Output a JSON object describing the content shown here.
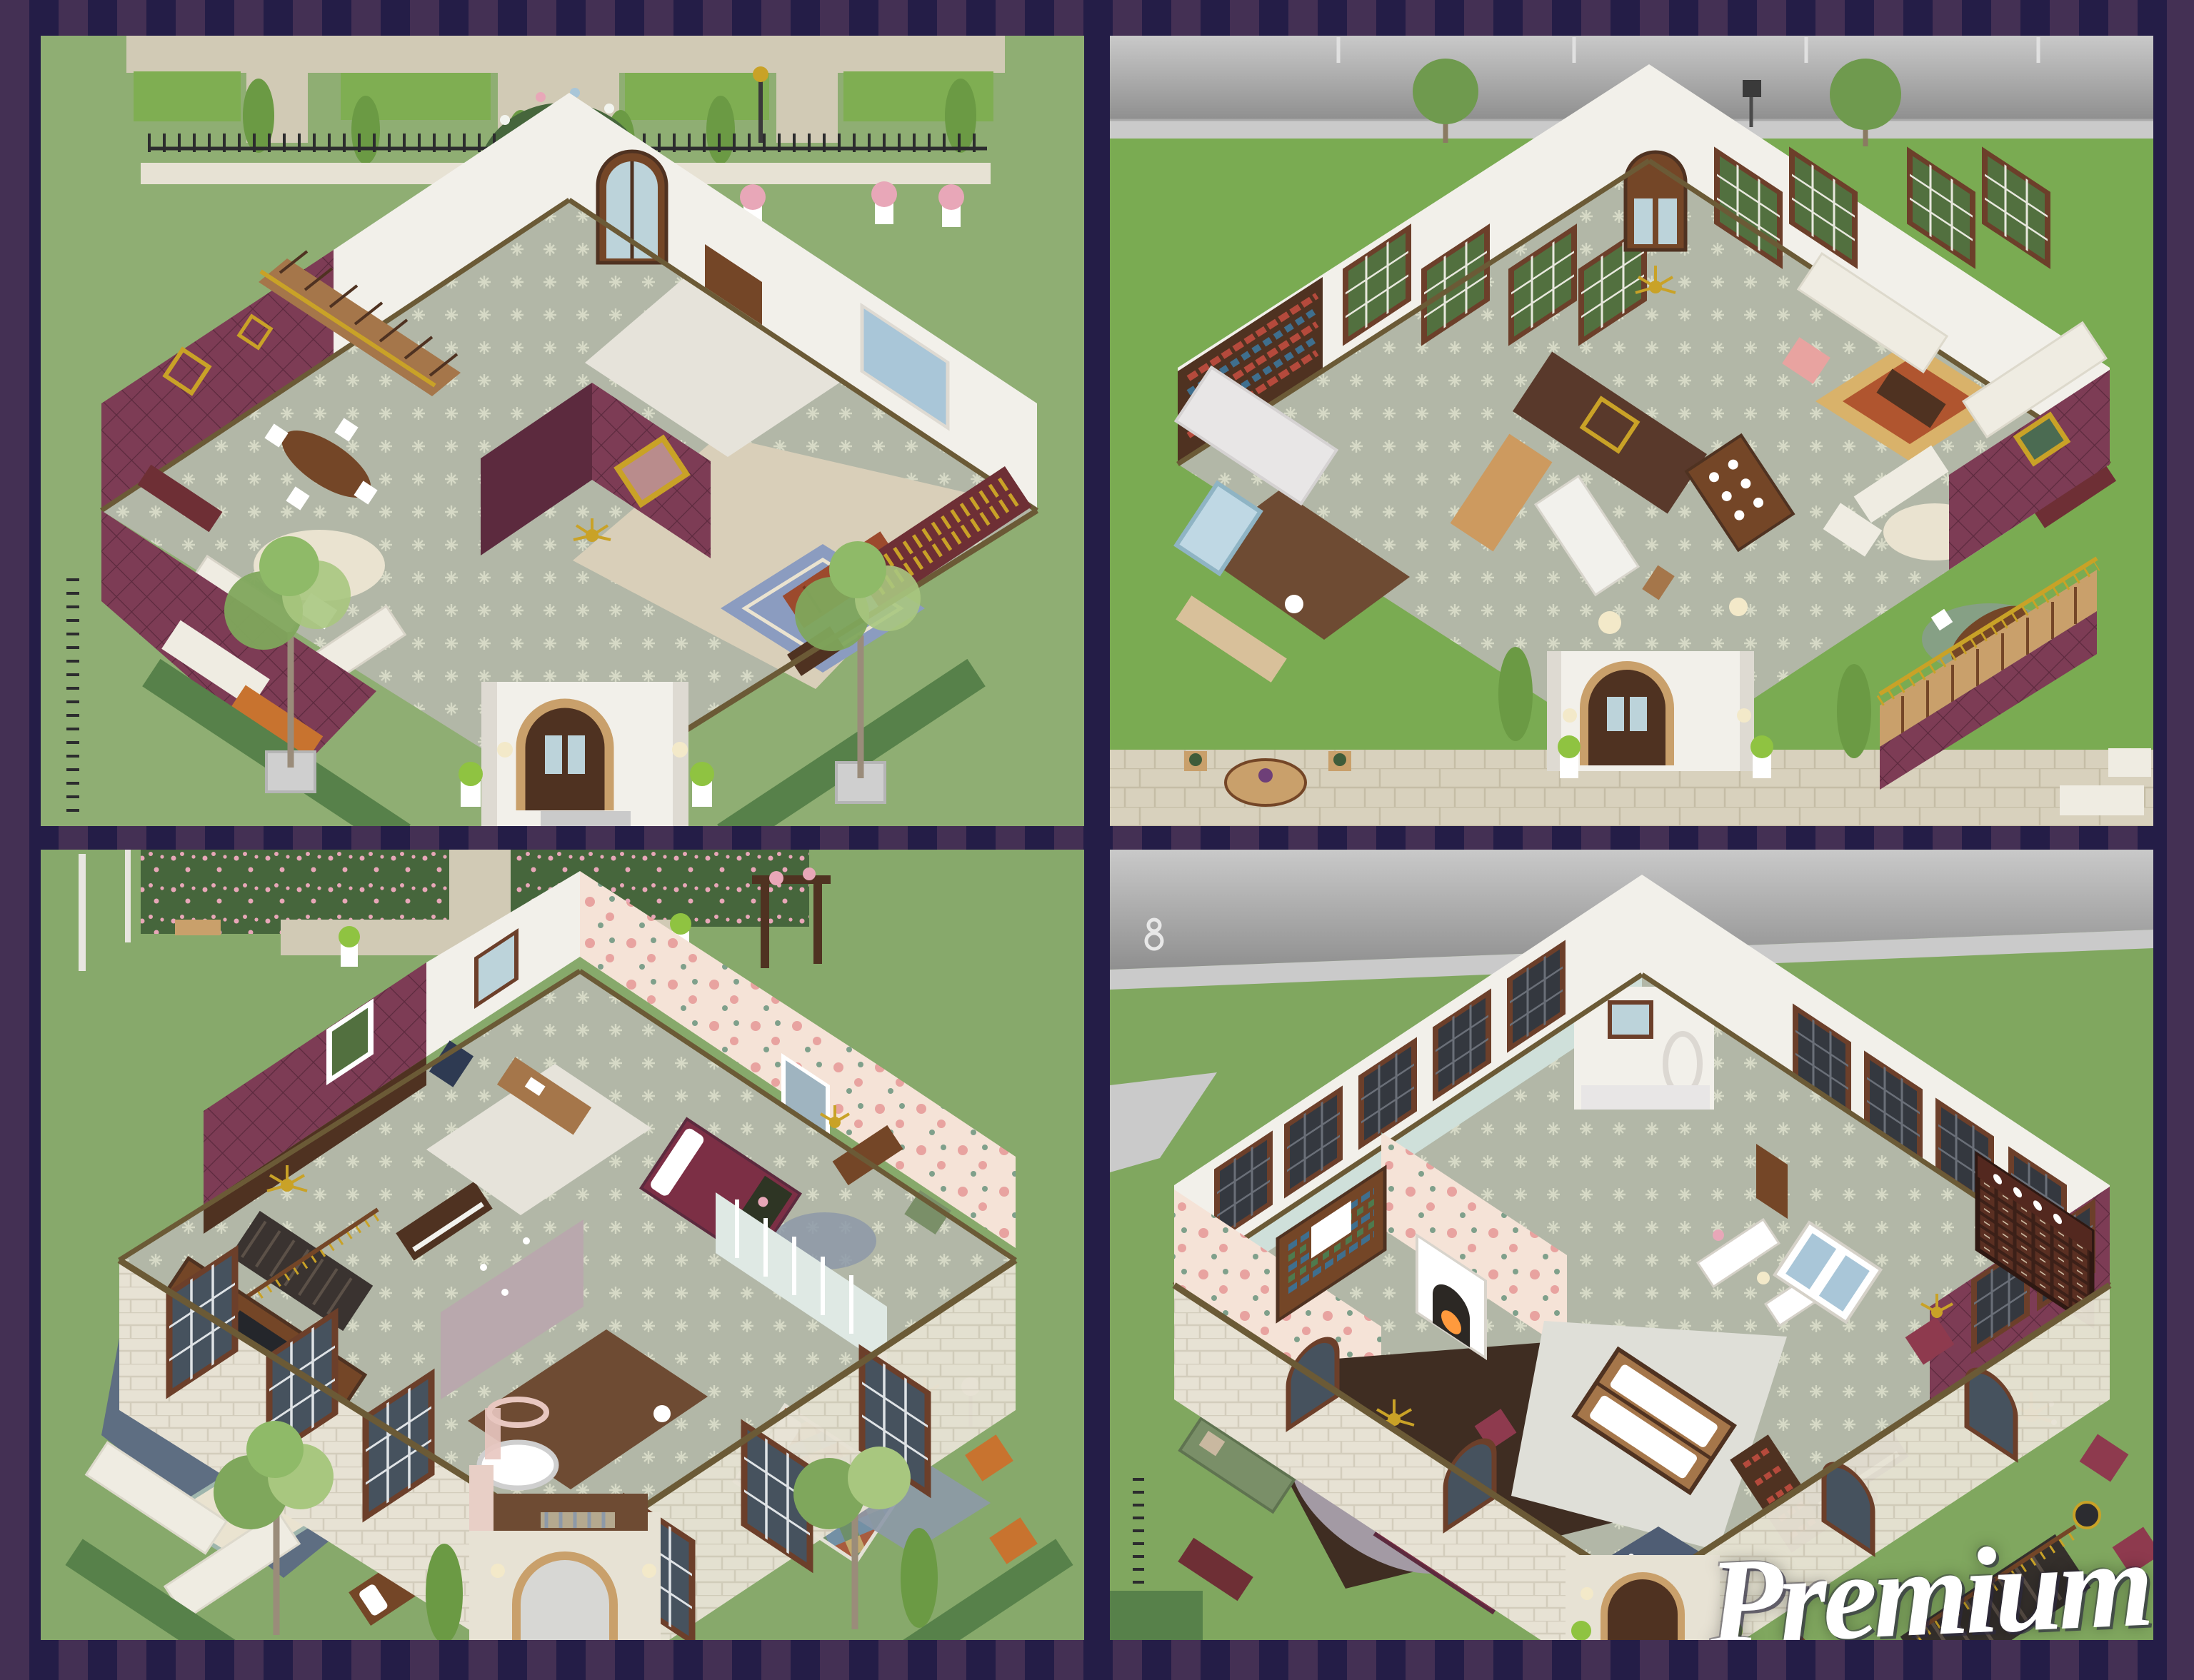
{
  "watermark": {
    "text": "Premium"
  },
  "panels": [
    {
      "id": "ground-floor-front-garden-view"
    },
    {
      "id": "ground-floor-street-view"
    },
    {
      "id": "upper-floor-front-garden-view"
    },
    {
      "id": "upper-floor-street-view"
    }
  ],
  "palette": {
    "frame_light": "#443054",
    "frame_dark": "#241d47",
    "grass_a": "#8fae73",
    "grass_b": "#7aab52",
    "grass_c": "#87a96b",
    "grass_d": "#80a75f",
    "hedge": "#57814a",
    "hedge_dark": "#46663c",
    "hedge_light": "#7fae52",
    "cypress": "#6b9a44",
    "topiary": "#8fc341",
    "rose_pink": "#e8a7b8",
    "rose_white": "#f2f4ee",
    "path": "#d1cab5",
    "path_dark": "#c0b9a4",
    "sidewalk": "#cacaca",
    "road_light": "#c9c9c9",
    "road_dark": "#8f8f8f",
    "pave": "#d8d1bd",
    "pave_line": "#c5bda6",
    "wall_white": "#f2f0ea",
    "wall_shade": "#dedad2",
    "stone": "#e7e2d4",
    "stone_line": "#d3cdbc",
    "maroon": "#7d3c55",
    "maroon_dark": "#5c2a3e",
    "maroon_deep": "#6e2f35",
    "wood": "#744627",
    "wood_dark": "#4f3221",
    "wood_light": "#a5764a",
    "wood_pale": "#c9a06b",
    "beam": "#6b5a36",
    "floor_gray": "#b2b7a7",
    "floor_star": "#d6d9c6",
    "floor_beige": "#d9cfb9",
    "floor_pale": "#e6e3da",
    "floor_wood": "#6e4b33",
    "floor_wood_dark": "#3f2d22",
    "carpet_blue": "#5e6e82",
    "rug_blue": "#8b9cc0",
    "rug_navy": "#4f5d74",
    "rug_cream": "#eae3d0",
    "rug_gray": "#8d99a8",
    "rug_heather": "#a39aa4",
    "rug_oriental": "#b0552f",
    "rug_oriental_border": "#d9b26a",
    "rug_teal": "#9fb6ad",
    "sofa_white": "#efece2",
    "sofa_red": "#9c4a2d",
    "sofa_green": "#7a8f68",
    "chair_maroon": "#8e3a4e",
    "chair_orange": "#c8732f",
    "chair_red": "#8a3040",
    "quilt_maroon": "#7c2f45",
    "quilt_1": "#a85c3f",
    "quilt_2": "#7390a5",
    "quilt_3": "#c2aa6e",
    "quilt_4": "#6e8f6a",
    "glass": "#bcd3da",
    "glass_blue": "#a9c6d8",
    "green_glass": "#52703f",
    "stained": "#34383f",
    "window_frame": "#6c3f2a",
    "gold": "#c9a227",
    "fence": "#2c2c2e",
    "white": "#ffffff",
    "cream": "#f6f3ec",
    "tv": "#24262b",
    "fire": "#ff9a3d",
    "lamp": "#f3e9c9",
    "floral_bg": "#f5e3d7",
    "floral_pink": "#e8a3a0",
    "floral_leaf": "#7fa08b",
    "teal_wall": "#cfe0da",
    "stripe_wall": "#dfe9e4",
    "damask": "#b9a8ad",
    "tile_wall": "#e8e6e6",
    "shower": "#bfd8e4",
    "marble": "#f2f1ec",
    "book_1": "#b54a3c",
    "book_2": "#3f6f8e",
    "book_3": "#c9a227",
    "book_4": "#4e7a4e"
  }
}
